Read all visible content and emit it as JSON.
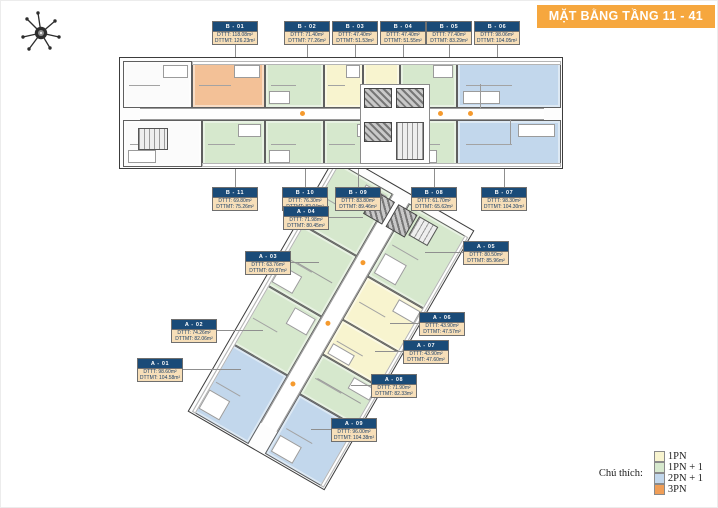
{
  "banner": {
    "title": "MẶT BẰNG TẦNG 11 - 41",
    "bg_color": "#f6a73e"
  },
  "compass": {
    "icon": "compass-rose"
  },
  "legend": {
    "label": "Chú thích:",
    "items": [
      {
        "label": "1PN",
        "color": "#f8f4cf"
      },
      {
        "label": "1PN + 1",
        "color": "#d6e8cd"
      },
      {
        "label": "2PN + 1",
        "color": "#c2d7ec"
      },
      {
        "label": "3PN",
        "color": "#f09e57"
      }
    ]
  },
  "colors": {
    "callout_header": "#1a4b78",
    "callout_body": "#f7dfb9",
    "banner_orange": "#f6a73e",
    "wall": "#3c3c3c"
  },
  "units": [
    {
      "id": "B - 01",
      "type": "3PN",
      "dtt": "DTTT: 118.08m²",
      "dtmt": "DTTMT: 126.23m²",
      "box": {
        "x": 211,
        "y": 20
      },
      "line": {
        "dir": "down",
        "len": 13
      }
    },
    {
      "id": "B - 02",
      "type": "1PN + 1",
      "dtt": "DTTT: 71.40m²",
      "dtmt": "DTTMT: 77.26m²",
      "box": {
        "x": 283,
        "y": 20
      },
      "line": {
        "dir": "down",
        "len": 13
      }
    },
    {
      "id": "B - 03",
      "type": "1PN",
      "dtt": "DTTT: 47.40m²",
      "dtmt": "DTTMT: 51.53m²",
      "box": {
        "x": 331,
        "y": 20
      },
      "line": {
        "dir": "down",
        "len": 13
      }
    },
    {
      "id": "B - 04",
      "type": "1PN",
      "dtt": "DTTT: 47.40m²",
      "dtmt": "DTTMT: 51.55m²",
      "box": {
        "x": 379,
        "y": 20
      },
      "line": {
        "dir": "down",
        "len": 13
      }
    },
    {
      "id": "B - 05",
      "type": "1PN + 1",
      "dtt": "DTTT: 77.40m²",
      "dtmt": "DTTMT: 83.29m²",
      "box": {
        "x": 425,
        "y": 20
      },
      "line": {
        "dir": "down",
        "len": 13
      }
    },
    {
      "id": "B - 06",
      "type": "2PN + 1",
      "dtt": "DTTT: 98.06m²",
      "dtmt": "DTTMT: 104.05m²",
      "box": {
        "x": 473,
        "y": 20
      },
      "line": {
        "dir": "down",
        "len": 13
      }
    },
    {
      "id": "B - 07",
      "type": "2PN + 1",
      "dtt": "DTTT: 98.30m²",
      "dtmt": "DTTMT: 104.30m²",
      "box": {
        "x": 480,
        "y": 186
      },
      "line": {
        "dir": "up",
        "len": 18
      }
    },
    {
      "id": "B - 08",
      "type": "1PN + 1",
      "dtt": "DTTT: 61.70m²",
      "dtmt": "DTTMT: 65.62m²",
      "box": {
        "x": 410,
        "y": 186
      },
      "line": {
        "dir": "up",
        "len": 18
      }
    },
    {
      "id": "B - 09",
      "type": "1PN + 1",
      "dtt": "DTTT: 83.80m²",
      "dtmt": "DTTMT: 89.46m²",
      "box": {
        "x": 334,
        "y": 186
      },
      "line": {
        "dir": "up",
        "len": 18
      }
    },
    {
      "id": "B - 10",
      "type": "1PN + 1",
      "dtt": "DTTT: 76.30m²",
      "dtmt": "DTTMT: 82.04m²",
      "box": {
        "x": 281,
        "y": 186
      },
      "line": {
        "dir": "up",
        "len": 18
      }
    },
    {
      "id": "B - 11",
      "type": "1PN + 1",
      "dtt": "DTTT: 69.80m²",
      "dtmt": "DTTMT: 75.26m²",
      "box": {
        "x": 211,
        "y": 186
      },
      "line": {
        "dir": "up",
        "len": 18
      }
    },
    {
      "id": "A - 01",
      "type": "2PN + 1",
      "dtt": "DTTT: 98.60m²",
      "dtmt": "DTTMT: 104.58m²",
      "box": {
        "x": 136,
        "y": 357
      },
      "line": {
        "dir": "right",
        "len": 58
      }
    },
    {
      "id": "A - 02",
      "type": "1PN + 1",
      "dtt": "DTTT: 74.26m²",
      "dtmt": "DTTMT: 82.06m²",
      "box": {
        "x": 170,
        "y": 318
      },
      "line": {
        "dir": "right",
        "len": 46
      }
    },
    {
      "id": "A - 03",
      "type": "1PN + 1",
      "dtt": "DTTT: 63.76m²",
      "dtmt": "DTTMT: 69.87m²",
      "box": {
        "x": 244,
        "y": 250
      },
      "line": {
        "dir": "right",
        "len": 28
      }
    },
    {
      "id": "A - 04",
      "type": "1PN + 1",
      "dtt": "DTTT: 71.98m²",
      "dtmt": "DTTMT: 80.45m²",
      "box": {
        "x": 282,
        "y": 205
      },
      "line": {
        "dir": "right",
        "len": 34
      }
    },
    {
      "id": "A - 05",
      "type": "1PN + 1",
      "dtt": "DTTT: 80.50m²",
      "dtmt": "DTTMT: 85.96m²",
      "box": {
        "x": 462,
        "y": 240
      },
      "line": {
        "dir": "left",
        "len": 38
      }
    },
    {
      "id": "A - 06",
      "type": "1PN",
      "dtt": "DTTT: 43.90m²",
      "dtmt": "DTTMT: 47.57m²",
      "box": {
        "x": 418,
        "y": 311
      },
      "line": {
        "dir": "left",
        "len": 29
      }
    },
    {
      "id": "A - 07",
      "type": "1PN",
      "dtt": "DTTT: 43.90m²",
      "dtmt": "DTTMT: 47.60m²",
      "box": {
        "x": 402,
        "y": 339
      },
      "line": {
        "dir": "left",
        "len": 28
      }
    },
    {
      "id": "A - 08",
      "type": "1PN + 1",
      "dtt": "DTTT: 71.90m²",
      "dtmt": "DTTMT: 82.33m²",
      "box": {
        "x": 370,
        "y": 373
      },
      "line": {
        "dir": "left",
        "len": 20
      }
    },
    {
      "id": "A - 09",
      "type": "2PN + 1",
      "dtt": "DTTT: 96.00m²",
      "dtmt": "DTTMT: 104.38m²",
      "box": {
        "x": 330,
        "y": 417
      },
      "line": {
        "dir": "left",
        "len": 20
      }
    }
  ]
}
